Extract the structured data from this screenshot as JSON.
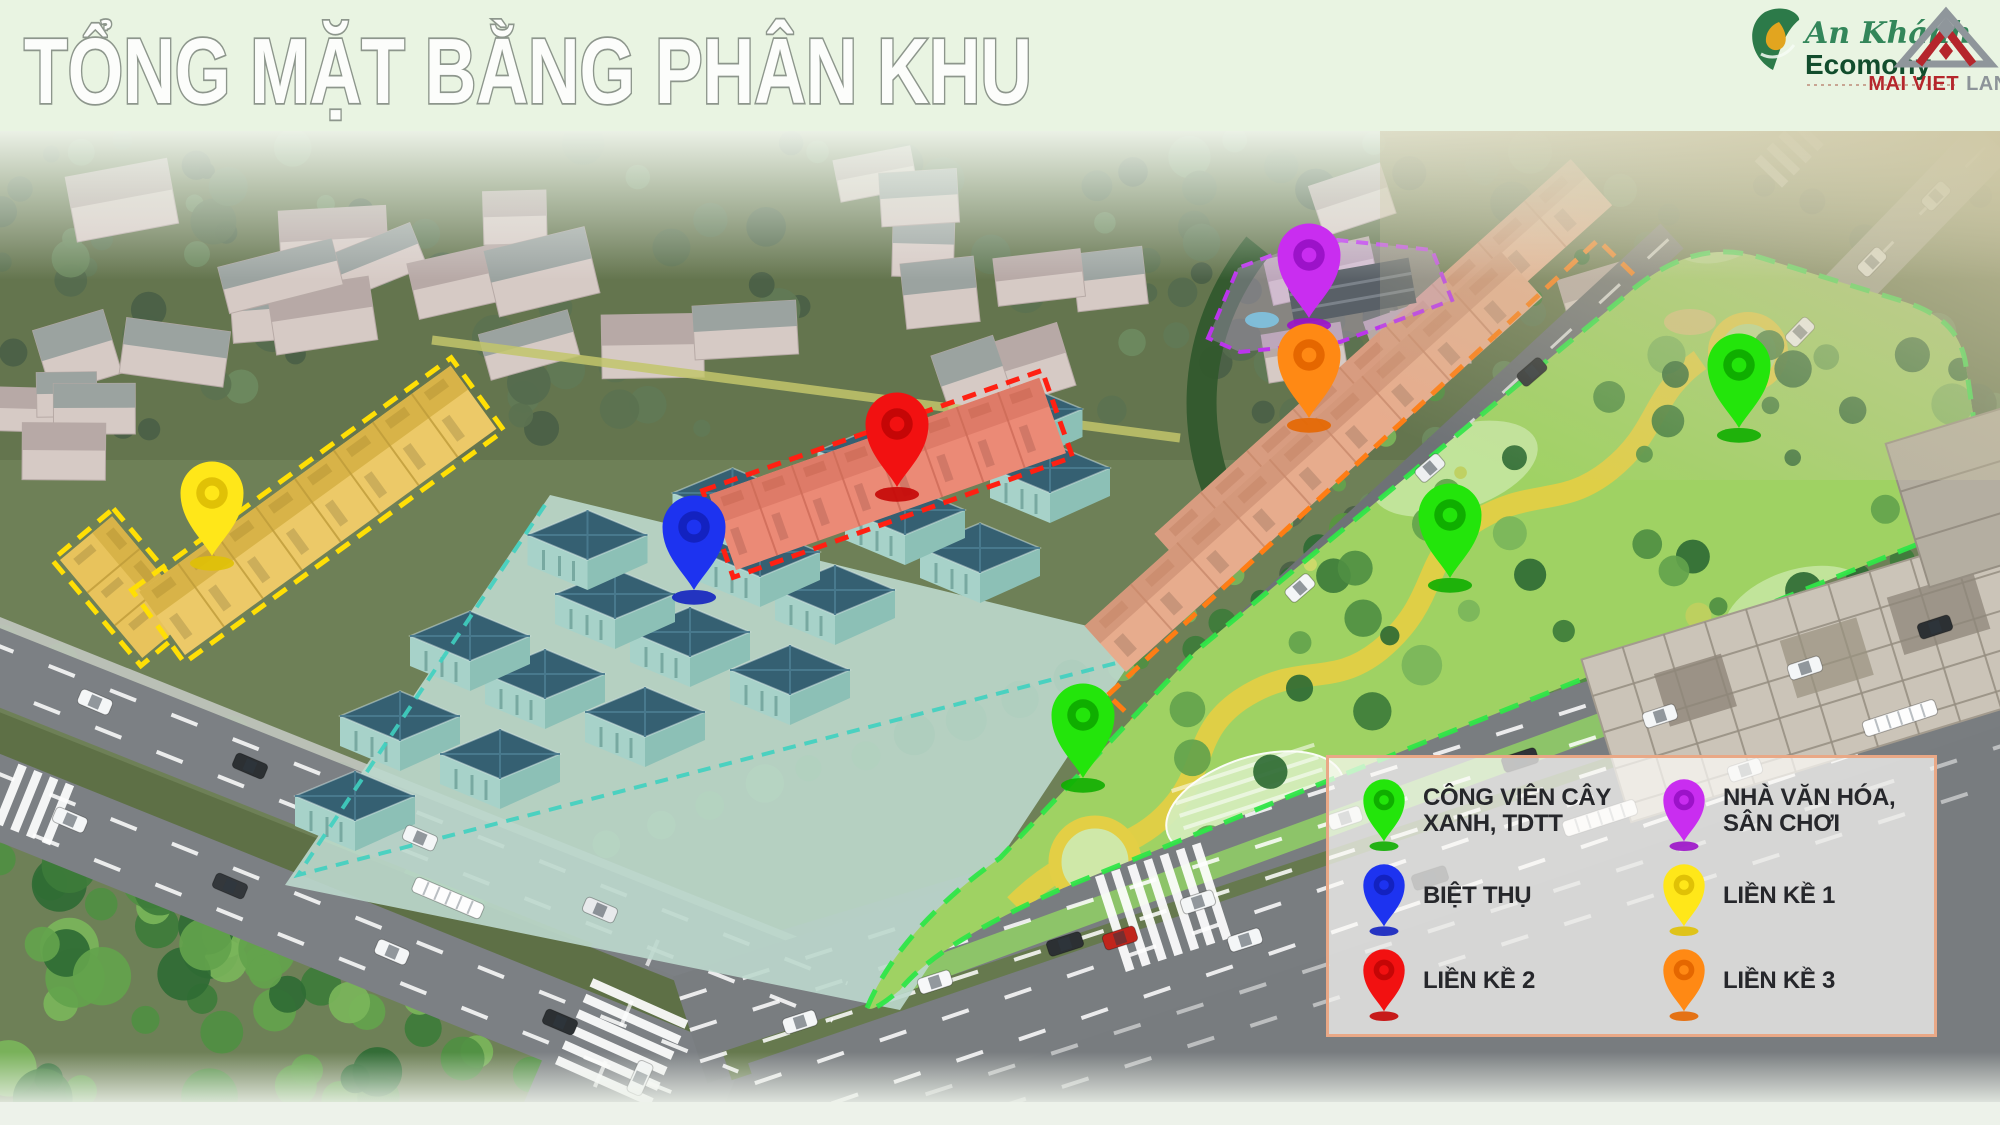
{
  "header": {
    "title": "TỔNG MẶT BẰNG PHÂN KHU",
    "logos": {
      "an_khanh": {
        "name": "An Khánh",
        "suffix": "Ecomony"
      },
      "mai_viet": {
        "name_primary": "MAI VIET",
        "name_secondary": "LAND"
      }
    }
  },
  "legend": {
    "items": [
      {
        "id": "cong-vien-cay-xanh",
        "label": "CÔNG VIÊN CÂY XANH, TDTT",
        "pin_color": "#23e50b",
        "pin_color_dark": "#0fae00"
      },
      {
        "id": "nha-van-hoa",
        "label": "NHÀ VĂN HÓA, SÂN CHƠI",
        "pin_color": "#c92df0",
        "pin_color_dark": "#9c12c9"
      },
      {
        "id": "biet-thu",
        "label": "BIỆT THỤ",
        "pin_color": "#1d33f0",
        "pin_color_dark": "#1322c0"
      },
      {
        "id": "lien-ke-1",
        "label": "LIỀN KỀ 1",
        "pin_color": "#ffe719",
        "pin_color_dark": "#e0c106"
      },
      {
        "id": "lien-ke-2",
        "label": "LIỀN KỀ 2",
        "pin_color": "#f21111",
        "pin_color_dark": "#c50606"
      },
      {
        "id": "lien-ke-3",
        "label": "LIỀN KỀ 3",
        "pin_color": "#ff8914",
        "pin_color_dark": "#e56700"
      }
    ]
  },
  "map": {
    "zone_outline_colors": {
      "lien-ke-1": "#ffdf05",
      "lien-ke-2": "#ff2012",
      "lien-ke-3": "#ff7d14",
      "biet-thu": "#3fd0c0",
      "nha-van-hoa": "#bb35ec",
      "cong-vien-cay-xanh": "#2fe648"
    },
    "pins": [
      {
        "zone": "lien-ke-1",
        "x": 212,
        "y": 556
      },
      {
        "zone": "biet-thu",
        "x": 694,
        "y": 590
      },
      {
        "zone": "lien-ke-2",
        "x": 897,
        "y": 487
      },
      {
        "zone": "nha-van-hoa",
        "x": 1309,
        "y": 318
      },
      {
        "zone": "lien-ke-3",
        "x": 1309,
        "y": 418
      },
      {
        "zone": "cong-vien-cay-xanh",
        "x": 1739,
        "y": 428
      },
      {
        "zone": "cong-vien-cay-xanh",
        "x": 1450,
        "y": 578
      },
      {
        "zone": "cong-vien-cay-xanh",
        "x": 1083,
        "y": 778
      }
    ]
  }
}
